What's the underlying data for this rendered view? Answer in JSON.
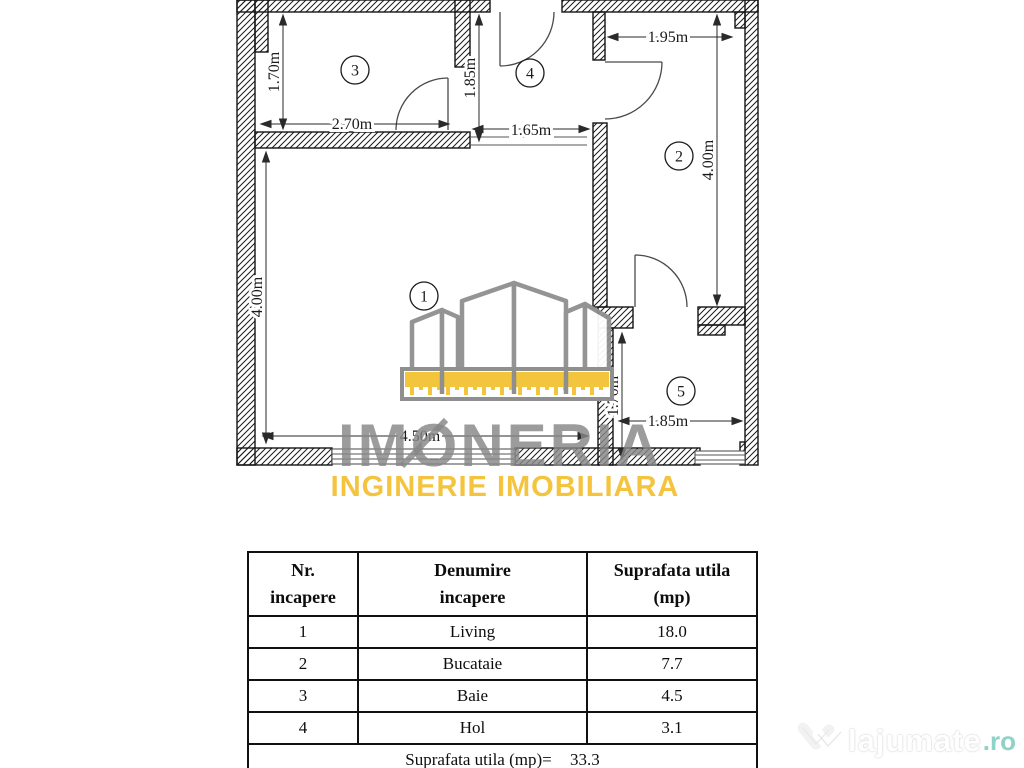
{
  "plan": {
    "labels": {
      "living": "1",
      "bucatarie": "2",
      "baie": "3",
      "hol": "4",
      "camera5": "5"
    },
    "dims": {
      "baie_h": "1.70m",
      "baie_w": "2.70m",
      "hol_h": "1.85m",
      "hol_w": "1.65m",
      "bucatarie_w": "1.95m",
      "bucatarie_h": "4.00m",
      "living_h": "4.00m",
      "living_w": "4.50m",
      "camera5_h": "1.70m",
      "camera5_w": "1.85m"
    }
  },
  "watermark": {
    "brand": "IMONERIA",
    "tagline": "INGINERIE IMOBILIARA",
    "brand_color": "#878787",
    "accent_color": "#f4c43e"
  },
  "table": {
    "headers": [
      {
        "line1": "Nr.",
        "line2": "incapere"
      },
      {
        "line1": "Denumire",
        "line2": "incapere"
      },
      {
        "line1": "Suprafata utila",
        "line2": "(mp)"
      }
    ],
    "rows": [
      {
        "nr": "1",
        "name": "Living",
        "area": "18.0"
      },
      {
        "nr": "2",
        "name": "Bucataie",
        "area": "7.7"
      },
      {
        "nr": "3",
        "name": "Baie",
        "area": "4.5"
      },
      {
        "nr": "4",
        "name": "Hol",
        "area": "3.1"
      }
    ],
    "total_label": "Suprafata utila (mp)=",
    "total_value": "33.3"
  },
  "site": {
    "name": "lajumate",
    "tld": ".ro",
    "tld_color": "#8ed2c9"
  }
}
